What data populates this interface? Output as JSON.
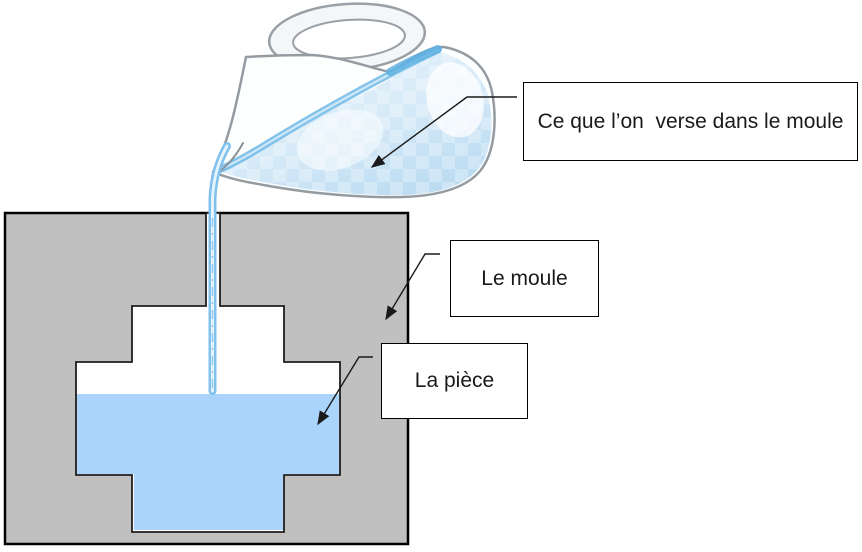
{
  "diagram": {
    "title_hint": "casting-mold-pouring-diagram",
    "labels": {
      "poured": "Ce que l’on  verse dans le moule",
      "mold": "Le moule",
      "piece": "La pièce"
    },
    "colors": {
      "background": "#ffffff",
      "mold_gray": "#c0c0c0",
      "mold_border": "#000000",
      "cavity_white": "#ffffff",
      "cavity_outline": "#1f1f1f",
      "cast_liquid": "#aad4fb",
      "stream_blue": "#7fc0ec",
      "stream_core": "#e4f3fc",
      "rim_water_blue": "#6db8e6",
      "pitcher_water_light": "#eaf5fc",
      "pitcher_water_deep": "#bcdcf2",
      "glass_outline": "#9aa0a5",
      "arrow": "#1a1a1a",
      "label_border": "#000000",
      "label_text": "#1a1a1a"
    }
  }
}
